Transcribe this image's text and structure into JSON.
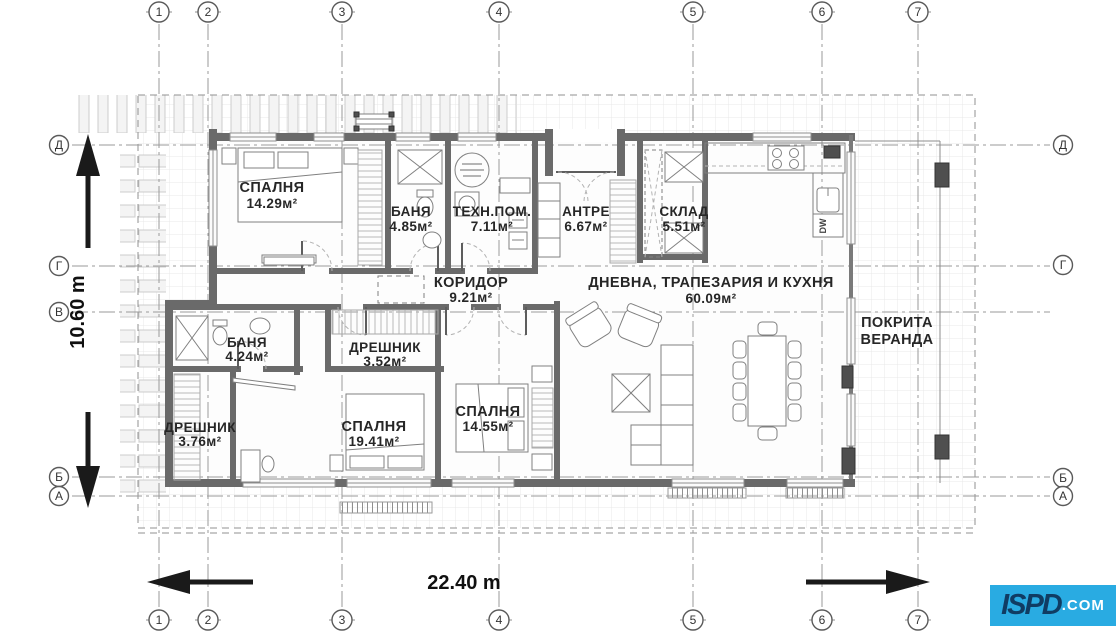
{
  "grid": {
    "cols": [
      "1",
      "2",
      "3",
      "4",
      "5",
      "6",
      "7"
    ],
    "rows_left": [
      "Д",
      "Г",
      "В",
      "Б",
      "А"
    ],
    "rows_right": [
      "Д",
      "Г",
      "Б",
      "А"
    ]
  },
  "rooms": [
    {
      "name": "СПАЛНЯ",
      "area": "14.29м²"
    },
    {
      "name": "БАНЯ",
      "area": "4.85м²"
    },
    {
      "name": "ТЕХН.ПОМ.",
      "area": "7.11м²"
    },
    {
      "name": "АНТРЕ",
      "area": "6.67м²"
    },
    {
      "name": "СКЛАД",
      "area": "5.51м²"
    },
    {
      "name": "КОРИДОР",
      "area": "9.21м²"
    },
    {
      "name": "ДНЕВНА, ТРАПЕЗАРИЯ И КУХНЯ",
      "area": "60.09м²"
    },
    {
      "name": "БАНЯ",
      "area": "4.24м²"
    },
    {
      "name": "ДРЕШНИК",
      "area": "3.52м²"
    },
    {
      "name": "ДРЕШНИК",
      "area": "3.76м²"
    },
    {
      "name": "СПАЛНЯ",
      "area": "19.41м²"
    },
    {
      "name": "СПАЛНЯ",
      "area": "14.55м²"
    }
  ],
  "veranda": {
    "line1": "ПОКРИТА",
    "line2": "ВЕРАНДА"
  },
  "dimensions": {
    "horizontal": "22.40 m",
    "vertical": "10.60 m"
  },
  "appliances": {
    "dishwasher": "DW"
  },
  "logo": {
    "name": "ISPD",
    "tld": ".COM"
  },
  "colors": {
    "wall": "#6a6a6a",
    "logo_bg": "#29abe2",
    "logo_text": "#103c63",
    "gridline": "#9a9a9a"
  }
}
